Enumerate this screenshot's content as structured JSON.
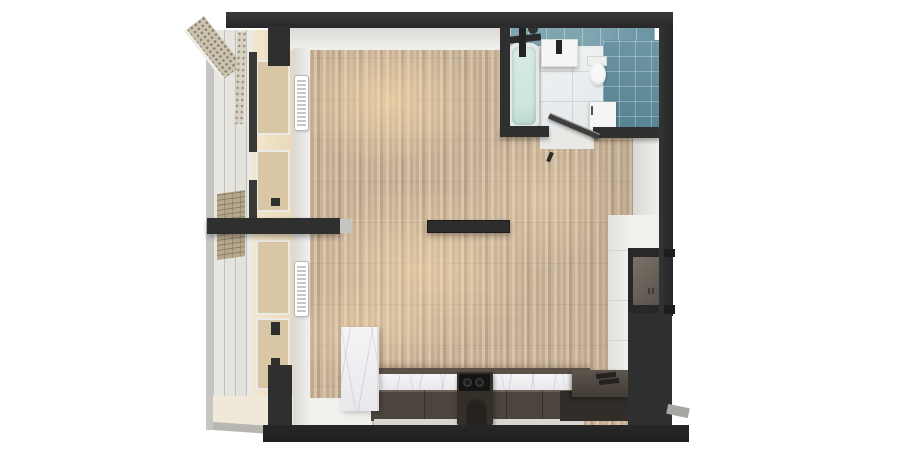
{
  "scene": {
    "title": "apartment-floorplan-3d-top-view",
    "palette": {
      "bg": "#ffffff",
      "wall": "#2f2f2f",
      "wall_dark": "#272727",
      "wall_edge": "#3a3a3a",
      "inner_wall": "#f1f0ed",
      "inner_wall_shade": "#d9d8d4",
      "wood1": "#cdb89e",
      "wood2": "#c0ab91",
      "wood3": "#d6c3aa",
      "wood4": "#b6a188",
      "wood5": "#c9b398",
      "sunlight": "#ffe0ac",
      "tile_top_a": "#7fa5b1",
      "tile_top_b": "#6b93a2",
      "tile_side_a": "#6f98a6",
      "tile_side_b": "#54808f",
      "bath_floor_a": "#f2f4f5",
      "bath_floor_b": "#e4e8ea",
      "water_a": "#cfe7df",
      "water_b": "#b9d8cf",
      "fixture_white": "#f5f5f4",
      "fixture_dark": "#232323",
      "marble_a": "#f4f4f6",
      "marble_b": "#e9e9ec",
      "marble_vein": "#969baa",
      "ledge": "#5b5147",
      "cabinet_face": "#4c453e",
      "cabinet_hl": "#6b6158",
      "counter_dark": "#322d28",
      "counter_top_a": "#5e564e",
      "counter_top_b": "#423c36",
      "cooktop": "#141414",
      "plinth": "#d9d5d0",
      "glass_light": "#e3e1dc",
      "glass_tan": "#ead9ba",
      "glass_pane": "#d9c6a4",
      "frame_white": "#eceae6",
      "frame_gray": "#c6c5c1",
      "brick": "#b6a78c",
      "cream_floor": "#f0e9da",
      "niche_a": "#7a7166",
      "niche_b": "#55504a",
      "endcap": "#c6c5c1"
    },
    "rooms": {
      "living_room": {
        "label": "living room",
        "floor": "wood parquet",
        "features": [
          "partition-wall-stub",
          "floating-partition-wall-stub",
          "sunlight-patches"
        ]
      },
      "bathroom": {
        "label": "bathroom",
        "wall_finish": "teal tiles",
        "fixtures": [
          "bathtub",
          "shower-mixer",
          "vanity-sink",
          "toilet",
          "washing-machine",
          "open-door"
        ]
      },
      "kitchen": {
        "label": "kitchen",
        "items": [
          "marble-countertop",
          "marble-end-panel",
          "dark-base-cabinets",
          "cooktop",
          "bar-stool",
          "l-shaped-counter",
          "serving-trays",
          "wall-niche",
          "tall-white-cabinets"
        ]
      },
      "balcony": {
        "label": "glazed balcony",
        "items": [
          "window-glazing",
          "window-panels",
          "radiator",
          "radiator",
          "brick-pier",
          "perforated-frame",
          "balcony-floor"
        ]
      }
    }
  }
}
